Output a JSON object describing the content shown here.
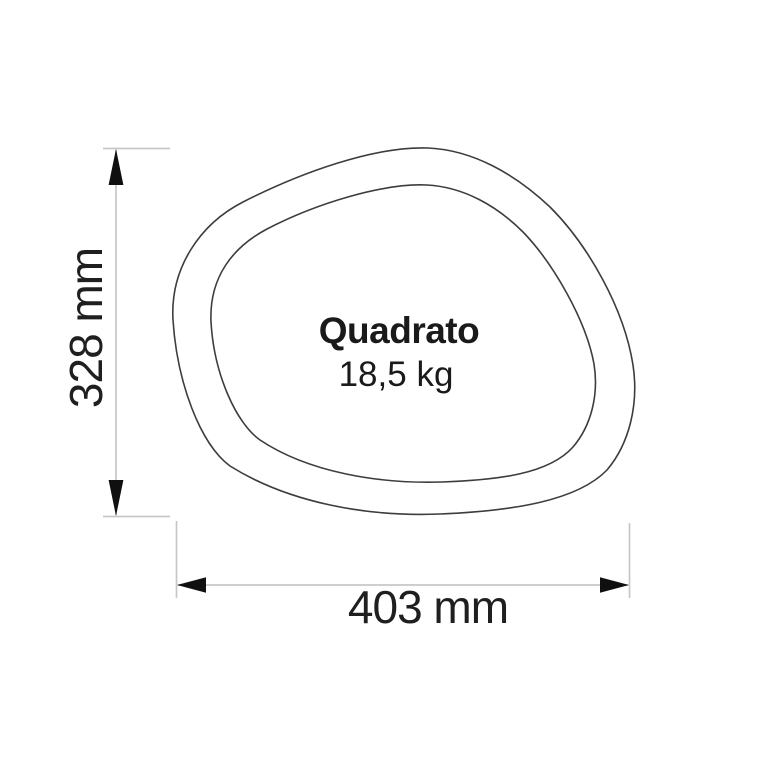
{
  "drawing": {
    "product_name": "Quadrato",
    "weight_label": "18,5 kg",
    "width_dimension_label": "403 mm",
    "height_dimension_label": "328 mm"
  },
  "colors": {
    "background": "#ffffff",
    "contour": "#3d3d3d",
    "dimension_line": "#c7c7c7",
    "arrowhead": "#101010",
    "text": "#1a1a1a"
  }
}
